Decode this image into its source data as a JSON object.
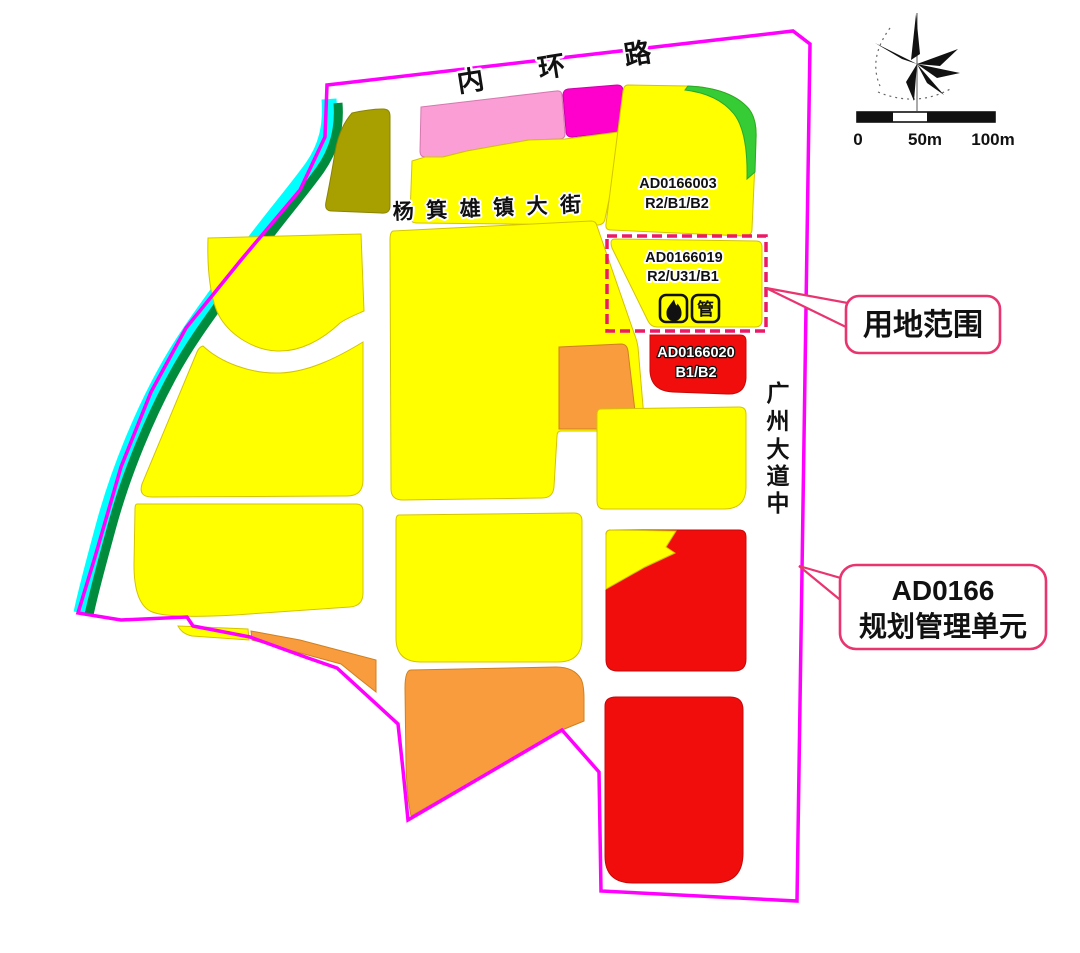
{
  "roads": {
    "inner_ring_chars": [
      "内",
      "环",
      "路"
    ],
    "street": "杨箕雄镇大街",
    "avenue_chars": [
      "广",
      "州",
      "大",
      "道",
      "中"
    ]
  },
  "parcels": {
    "p003": {
      "id": "AD0166003",
      "use": "R2/B1/B2"
    },
    "p019": {
      "id": "AD0166019",
      "use": "R2/U31/B1",
      "pipe_icon_char": "管",
      "icons": [
        "flame-icon",
        "pipe-icon"
      ]
    },
    "p020": {
      "id": "AD0166020",
      "use": "B1/B2"
    }
  },
  "callouts": {
    "land_scope": "用地范围",
    "unit_line1": "AD0166",
    "unit_line2": "规划管理单元"
  },
  "scalebar": {
    "t0": "0",
    "t50": "50m",
    "t100": "100m"
  },
  "colors": {
    "boundary": "#FF00FF",
    "residential_yellow": "#FFFF00",
    "commercial_red": "#F20D0D",
    "orange": "#F99C3D",
    "pink": "#FB9ED6",
    "magenta_parcel": "#FF00CC",
    "green": "#35CC35",
    "greenbelt": "#008C3C",
    "river_cyan": "#00FFFF",
    "olive": "#A8A000",
    "dashed_box": "#EB1A67",
    "callout_border": "#E8356F"
  }
}
